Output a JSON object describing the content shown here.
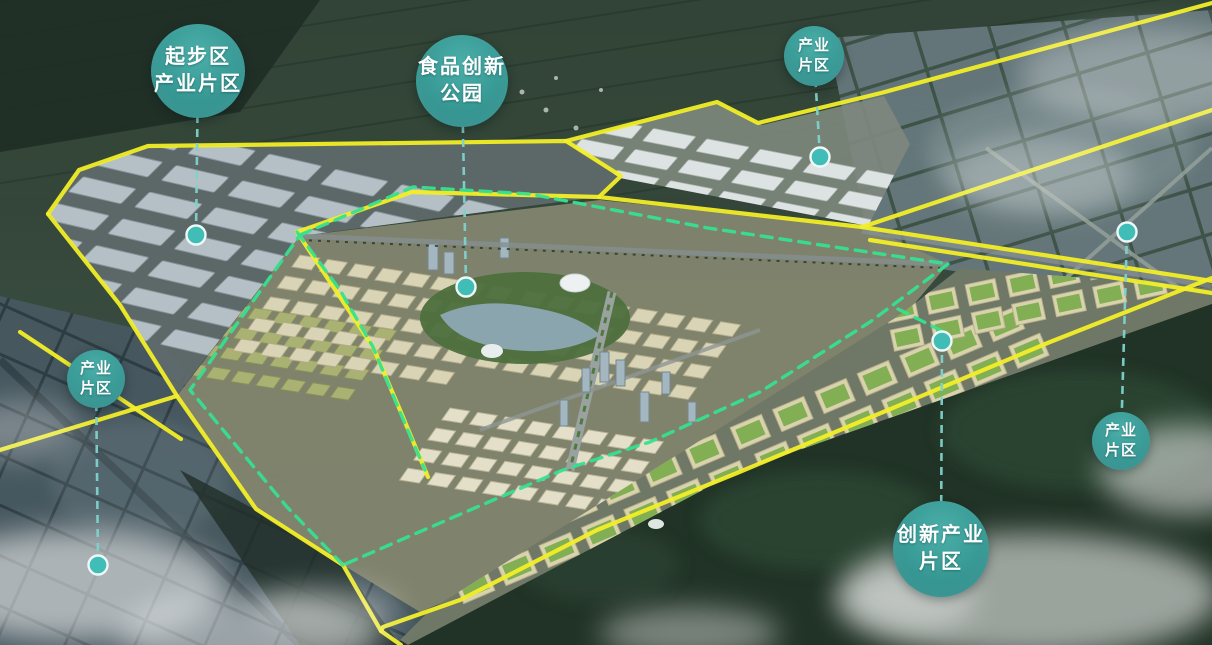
{
  "labels": [
    {
      "id": "startup-industrial",
      "lines": [
        "起步区",
        "产业片区"
      ],
      "cx": 198,
      "cy": 71,
      "r": 47,
      "dot": {
        "x": 196,
        "y": 235
      }
    },
    {
      "id": "food-innovation-park",
      "lines": [
        "食品创新",
        "公园"
      ],
      "cx": 462,
      "cy": 81,
      "r": 46,
      "dot": {
        "x": 466,
        "y": 287
      }
    },
    {
      "id": "industrial-north",
      "lines": [
        "产业",
        "片区"
      ],
      "cx": 814,
      "cy": 56,
      "r": 30,
      "dot": {
        "x": 820,
        "y": 157
      }
    },
    {
      "id": "industrial-west",
      "lines": [
        "产业",
        "片区"
      ],
      "cx": 96,
      "cy": 379,
      "r": 29,
      "dot": {
        "x": 98,
        "y": 565
      }
    },
    {
      "id": "industrial-east",
      "lines": [
        "产业",
        "片区"
      ],
      "cx": 1121,
      "cy": 441,
      "r": 29,
      "dot": {
        "x": 1127,
        "y": 232
      }
    },
    {
      "id": "innovation-industrial",
      "lines": [
        "创新产业",
        "片区"
      ],
      "cx": 941,
      "cy": 549,
      "r": 48,
      "dot": {
        "x": 942,
        "y": 341
      }
    }
  ],
  "colors": {
    "label_teal_light": "#4bafa9",
    "label_teal_dark": "#2f8f8c",
    "label_text": "#ffffff",
    "boundary_yellow": "#f2ee28",
    "boundary_green": "#36e08f",
    "connector": "#7fd2cc",
    "dot_fill": "#3fbdb6",
    "dot_ring": "#eef8f6"
  }
}
